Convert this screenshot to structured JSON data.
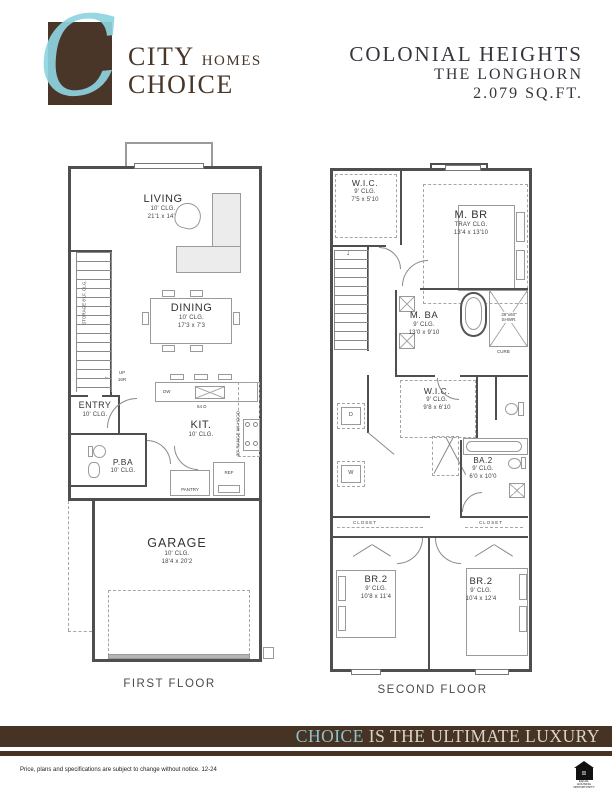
{
  "header": {
    "monogram": "C",
    "brand_top_main": "CITY",
    "brand_top_sub": "HOMES",
    "brand_bottom": "CHOICE",
    "community": "COLONIAL HEIGHTS",
    "plan_name": "THE LONGHORN",
    "area": "2.079 SQ.FT."
  },
  "first_floor": {
    "caption": "FIRST FLOOR",
    "living": {
      "name": "LIVING",
      "clg": "10' CLG.",
      "dims": "21'1 x 14'2"
    },
    "dining": {
      "name": "DINING",
      "clg": "10' CLG.",
      "dims": "17'3 x 7'3"
    },
    "kitchen": {
      "name": "KIT.",
      "clg": "10' CLG."
    },
    "entry": {
      "name": "ENTRY",
      "clg": "10' CLG."
    },
    "powder_bath": {
      "name": "P.BA",
      "clg": "10' CLG."
    },
    "garage": {
      "name": "GARAGE",
      "clg": "10' CLG.",
      "dims": "18'4 x 20'2"
    },
    "storage_note": "STORAGE 8'LF. CLG.",
    "stairs_up": "UP",
    "stairs_risers": "16R",
    "stairs_arrow": "←",
    "dishwasher": "DW",
    "island_note": "54 D",
    "range_note": "30\" RANGE W/ HOOD",
    "pantry": "PANTRY",
    "fridge": "REF"
  },
  "second_floor": {
    "caption": "SECOND FLOOR",
    "wic1": {
      "name": "W.I.C.",
      "clg": "9' CLG.",
      "dims": "7'5 x 5'10"
    },
    "master_bedroom": {
      "name": "M. BR",
      "clg": "TRAY CLG.",
      "dims": "13'4 x 13'10"
    },
    "master_bath": {
      "name": "M. BA",
      "clg": "9' CLG.",
      "dims": "13'0 x 9'10"
    },
    "wic2": {
      "name": "W.I.C.",
      "clg": "9' CLG.",
      "dims": "9'8 x 6'10"
    },
    "bath2": {
      "name": "BA.2",
      "clg": "9' CLG.",
      "dims": "6'0 x 10'0"
    },
    "bedroom2_left": {
      "name": "BR.2",
      "clg": "9' CLG.",
      "dims": "10'8 x 11'4"
    },
    "bedroom2_right": {
      "name": "BR.2",
      "clg": "9' CLG.",
      "dims": "10'4 x 12'4"
    },
    "shower_note_1": "36\"x60\"",
    "shower_note_2": "SHWR.",
    "curb_note": "CURB",
    "closet_left": "CLOSET",
    "closet_right": "CLOSET",
    "dryer": "D",
    "washer": "W",
    "down_arrow": "↓"
  },
  "footer": {
    "banner_highlight": "CHOICE",
    "banner_rest": " IS THE ULTIMATE LUXURY",
    "disclaimer": "Price, plans and specifications are subject to change without notice. 12-24",
    "equal_housing_symbol": "=",
    "equal_housing_label": "EQUAL HOUSING OPPORTUNITY"
  },
  "colors": {
    "brand_brown": "#4a3629",
    "logo_cyan": "#8ed4e0",
    "banner_brown": "#463323",
    "banner_text": "#d9d4ca",
    "banner_highlight": "#8cc3cf"
  }
}
